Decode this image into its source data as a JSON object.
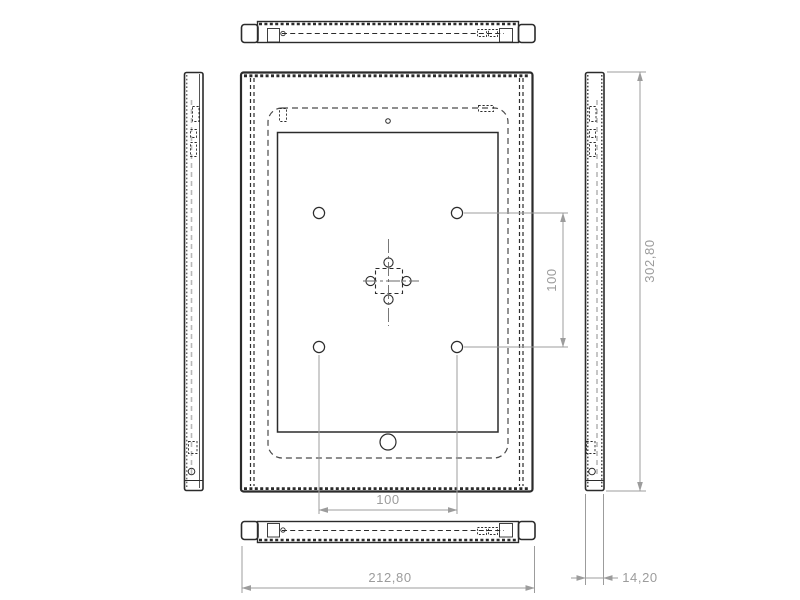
{
  "drawing": {
    "type": "technical-orthographic-drawing",
    "subject": "tablet enclosure frame",
    "background_color": "#ffffff",
    "line_color": "#2b2b2b",
    "hidden_line_color": "#4a4a4a",
    "centerline_color": "#b8b8b8",
    "dimension_color": "#9c9c9c",
    "dimensions": {
      "overall_width": "212,80",
      "overall_height": "302,80",
      "depth": "14,20",
      "vesa_width": "100",
      "vesa_height": "100"
    }
  }
}
